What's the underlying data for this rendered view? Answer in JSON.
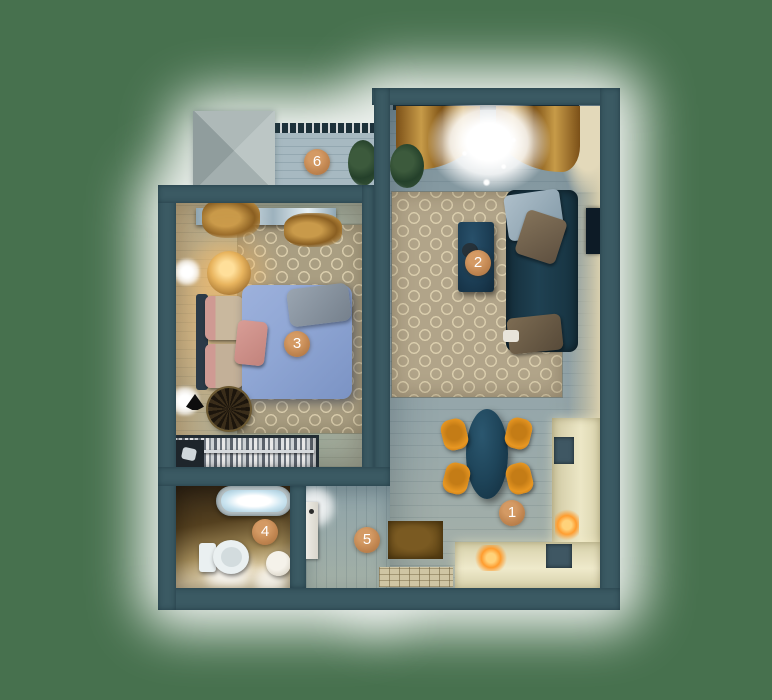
{
  "plan": {
    "markers": [
      {
        "number": "1",
        "room": "kitchen-dining"
      },
      {
        "number": "2",
        "room": "living-room"
      },
      {
        "number": "3",
        "room": "bedroom"
      },
      {
        "number": "4",
        "room": "bathroom"
      },
      {
        "number": "5",
        "room": "hallway"
      },
      {
        "number": "6",
        "room": "balcony"
      }
    ],
    "colors": {
      "background": "#47714e",
      "plan_glow": "#ffffff",
      "wall": "#3b5a63",
      "marker": "#c08550",
      "marker_text": "#ffffff",
      "living_floor": "#8da0a7",
      "rug": "#b1a489",
      "rug_pattern": "#dcd0af",
      "sofa": "#1f4152",
      "bed_duvet": "#8fa6d4",
      "accent_chairs": "#e89722",
      "kitchen_counter": "#ece7c6",
      "curtains_gold": "#c79b48",
      "bathroom_floor_warm": "#f2e7c6"
    }
  }
}
